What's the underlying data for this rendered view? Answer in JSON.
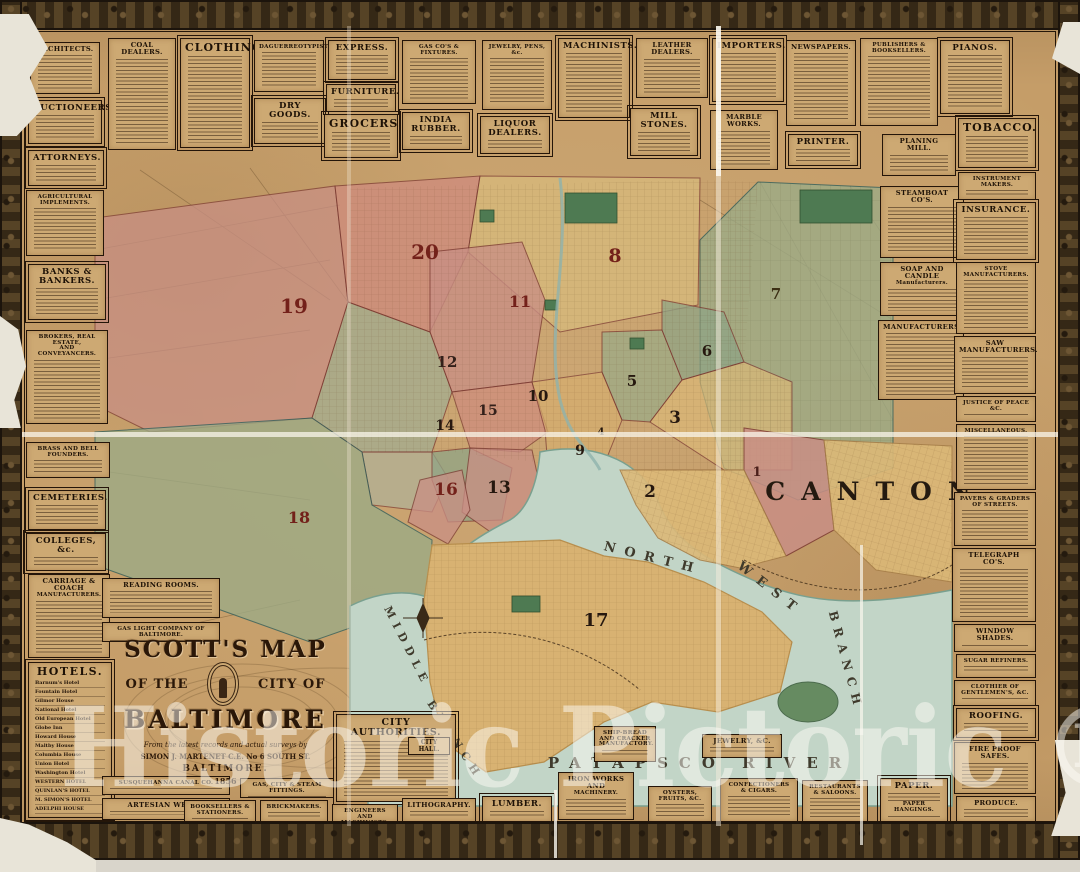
{
  "watermark": "Historic Pictoric ®",
  "cartouche": {
    "arc_title": "SCOTT'S MAP",
    "left": "OF THE",
    "right": "CITY OF",
    "city": "BALTIMORE",
    "sub1": "From the latest records and actual surveys by",
    "sub2": "SIMON J. MARTENET C.E. No 6 SOUTH ST.",
    "sub3": "BALTIMORE.",
    "date": "1856"
  },
  "colors": {
    "paper": "#c59d68",
    "frame": "#42331f",
    "water": "#c2d5c7",
    "ward_pink": "#c98f85",
    "ward_tan": "#d6ae6e",
    "ward_green": "#9cab86",
    "ward_number_red": "#73211a",
    "ink": "#241509",
    "watermark_white": "rgba(253,251,245,0.5)"
  },
  "map": {
    "region_label": "CANTON",
    "canton": {
      "x": 876,
      "y": 500,
      "s": 25,
      "ls": 16
    },
    "water_labels": [
      {
        "text": "NORTH",
        "x": 652,
        "y": 562,
        "s": 13,
        "r": 14,
        "ls": 9
      },
      {
        "text": "WEST",
        "x": 768,
        "y": 592,
        "s": 13,
        "r": 38,
        "ls": 9
      },
      {
        "text": "BRANCH",
        "x": 842,
        "y": 662,
        "s": 12,
        "r": 75,
        "ls": 7
      },
      {
        "text": "MIDDLE",
        "x": 404,
        "y": 648,
        "s": 11,
        "r": 63,
        "ls": 6
      },
      {
        "text": "BRANCH",
        "x": 452,
        "y": 742,
        "s": 11,
        "r": 57,
        "ls": 6
      },
      {
        "text": "PATAPSCO RIVER",
        "x": 700,
        "y": 768,
        "s": 15,
        "r": 0,
        "ls": 11
      }
    ],
    "wards": [
      {
        "n": "1",
        "x": 757,
        "y": 476,
        "s": 13,
        "c": "#4a1f1a"
      },
      {
        "n": "2",
        "x": 650,
        "y": 497,
        "s": 17,
        "c": "#26180f"
      },
      {
        "n": "3",
        "x": 675,
        "y": 423,
        "s": 17,
        "c": "#26180f"
      },
      {
        "n": "4",
        "x": 601,
        "y": 435,
        "s": 10,
        "c": "#26180f"
      },
      {
        "n": "5",
        "x": 632,
        "y": 386,
        "s": 15,
        "c": "#26180f"
      },
      {
        "n": "6",
        "x": 707,
        "y": 356,
        "s": 15,
        "c": "#26180f"
      },
      {
        "n": "7",
        "x": 776,
        "y": 299,
        "s": 15,
        "c": "#3c2f14"
      },
      {
        "n": "8",
        "x": 615,
        "y": 262,
        "s": 19,
        "c": "#73211a"
      },
      {
        "n": "9",
        "x": 580,
        "y": 455,
        "s": 14,
        "c": "#26180f"
      },
      {
        "n": "10",
        "x": 538,
        "y": 401,
        "s": 15,
        "c": "#26180f"
      },
      {
        "n": "11",
        "x": 520,
        "y": 307,
        "s": 16,
        "c": "#73211a"
      },
      {
        "n": "12",
        "x": 447,
        "y": 367,
        "s": 15,
        "c": "#33201a"
      },
      {
        "n": "13",
        "x": 499,
        "y": 493,
        "s": 17,
        "c": "#26180f"
      },
      {
        "n": "14",
        "x": 445,
        "y": 430,
        "s": 14,
        "c": "#26180f"
      },
      {
        "n": "15",
        "x": 488,
        "y": 415,
        "s": 14,
        "c": "#33201a"
      },
      {
        "n": "16",
        "x": 446,
        "y": 495,
        "s": 17,
        "c": "#73211a"
      },
      {
        "n": "17",
        "x": 596,
        "y": 626,
        "s": 18,
        "c": "#26180f"
      },
      {
        "n": "18",
        "x": 299,
        "y": 523,
        "s": 16,
        "c": "#73211a"
      },
      {
        "n": "19",
        "x": 294,
        "y": 313,
        "s": 20,
        "c": "#73211a"
      },
      {
        "n": "20",
        "x": 425,
        "y": 259,
        "s": 20,
        "c": "#73211a"
      }
    ]
  },
  "panels": [
    {
      "id": "architects",
      "t": "ARCHITECTS.",
      "x": 30,
      "y": 42,
      "w": 70,
      "h": 52,
      "v": "n"
    },
    {
      "id": "auctioneers",
      "t": "AUCTIONEERS.",
      "x": 28,
      "y": 100,
      "w": 74,
      "h": 44,
      "v": "d2"
    },
    {
      "id": "attorneys",
      "t": "ATTORNEYS.",
      "x": 28,
      "y": 150,
      "w": 76,
      "h": 36,
      "v": "d2"
    },
    {
      "id": "coal-dealers",
      "t": "COAL DEALERS.",
      "x": 108,
      "y": 38,
      "w": 68,
      "h": 112,
      "v": "n"
    },
    {
      "id": "clothing",
      "t": "CLOTHING.",
      "x": 180,
      "y": 38,
      "w": 70,
      "h": 110,
      "v": "d"
    },
    {
      "id": "daguerreotypists",
      "t": "DAGUERREOTYPISTS.",
      "x": 254,
      "y": 40,
      "w": 70,
      "h": 52,
      "v": "s"
    },
    {
      "id": "dry-goods",
      "t": "DRY GOODS.",
      "x": 254,
      "y": 98,
      "w": 72,
      "h": 46,
      "v": "d2"
    },
    {
      "id": "express",
      "t": "EXPRESS.",
      "x": 328,
      "y": 40,
      "w": 68,
      "h": 40,
      "v": "d2"
    },
    {
      "id": "furniture",
      "t": "FURNITURE.",
      "x": 326,
      "y": 84,
      "w": 70,
      "h": 28,
      "v": "d2"
    },
    {
      "id": "grocers",
      "t": "GROCERS.",
      "x": 324,
      "y": 114,
      "w": 74,
      "h": 44,
      "v": "d"
    },
    {
      "id": "gas-cos-fixtures",
      "t": "GAS CO'S & FIXTURES.",
      "x": 402,
      "y": 40,
      "w": 74,
      "h": 64,
      "v": "s"
    },
    {
      "id": "india-rubber",
      "t": "INDIA RUBBER.",
      "x": 402,
      "y": 112,
      "w": 68,
      "h": 38,
      "v": "d2"
    },
    {
      "id": "jewelry-pens",
      "t": "JEWELRY, PENS, &c.",
      "x": 482,
      "y": 40,
      "w": 70,
      "h": 70,
      "v": "s"
    },
    {
      "id": "liquor-dealers",
      "t": "LIQUOR DEALERS.",
      "x": 480,
      "y": 116,
      "w": 70,
      "h": 38,
      "v": "d2"
    },
    {
      "id": "machinists",
      "t": "MACHINISTS.",
      "x": 558,
      "y": 38,
      "w": 72,
      "h": 80,
      "v": "d2"
    },
    {
      "id": "mill-stones",
      "t": "MILL STONES.",
      "x": 630,
      "y": 108,
      "w": 68,
      "h": 48,
      "v": "d2"
    },
    {
      "id": "leather-dealers",
      "t": "LEATHER DEALERS.",
      "x": 636,
      "y": 38,
      "w": 72,
      "h": 60,
      "v": "n"
    },
    {
      "id": "importers",
      "t": "IMPORTERS.",
      "x": 712,
      "y": 38,
      "w": 72,
      "h": 64,
      "v": "d2"
    },
    {
      "id": "marble-works",
      "t": "MARBLE WORKS.",
      "x": 710,
      "y": 110,
      "w": 68,
      "h": 60,
      "v": "n"
    },
    {
      "id": "newspapers",
      "t": "NEWSPAPERS.",
      "x": 786,
      "y": 40,
      "w": 70,
      "h": 86,
      "v": "n"
    },
    {
      "id": "printer",
      "t": "PRINTER.",
      "x": 788,
      "y": 134,
      "w": 70,
      "h": 32,
      "v": "d2"
    },
    {
      "id": "publishers-booksellers",
      "t": "PUBLISHERS & BOOKSELLERS.",
      "x": 860,
      "y": 38,
      "w": 78,
      "h": 88,
      "v": "s"
    },
    {
      "id": "planing-mill",
      "t": "PLANING MILL.",
      "x": 882,
      "y": 134,
      "w": 74,
      "h": 42,
      "v": "n"
    },
    {
      "id": "pianos",
      "t": "PIANOS.",
      "x": 940,
      "y": 40,
      "w": 70,
      "h": 74,
      "v": "d2"
    },
    {
      "id": "tobacco",
      "t": "TOBACCO.",
      "x": 958,
      "y": 118,
      "w": 78,
      "h": 50,
      "v": "d"
    },
    {
      "id": "agricultural-implements",
      "t": "AGRICULTURAL IMPLEMENTS.",
      "x": 26,
      "y": 190,
      "w": 78,
      "h": 66,
      "v": "s"
    },
    {
      "id": "banks-bankers",
      "t": "BANKS & BANKERS.",
      "x": 28,
      "y": 264,
      "w": 78,
      "h": 56,
      "v": "d2"
    },
    {
      "id": "brokers",
      "t": "BROKERS, REAL ESTATE,|AND CONVEYANCERS.",
      "x": 26,
      "y": 330,
      "w": 82,
      "h": 94,
      "v": "s"
    },
    {
      "id": "brass-bell-founders",
      "t": "BRASS AND BELL FOUNDERS.",
      "x": 26,
      "y": 442,
      "w": 84,
      "h": 36,
      "v": "s"
    },
    {
      "id": "cemeteries",
      "t": "CEMETERIES.",
      "x": 28,
      "y": 490,
      "w": 78,
      "h": 40,
      "v": "d2"
    },
    {
      "id": "colleges",
      "t": "COLLEGES, &c.",
      "x": 26,
      "y": 533,
      "w": 80,
      "h": 38,
      "v": "d2"
    },
    {
      "id": "carriage-coach",
      "t": "CARRIAGE & COACH|MANUFACTURERS.",
      "x": 28,
      "y": 574,
      "w": 82,
      "h": 84,
      "v": "n"
    },
    {
      "id": "hotels",
      "t": "HOTELS.",
      "x": 28,
      "y": 662,
      "w": 84,
      "h": 156,
      "v": "hotels",
      "list": [
        "Barnum's Hotel",
        "Fountain Hotel",
        "Gilmor House",
        "National Hotel",
        "Old European Hotel",
        "Globe Inn",
        "Howard House",
        "Maltby House",
        "Columbia House",
        "Union Hotel",
        "Washington Hotel",
        "WESTERN HOTEL",
        "QUINLAN'S HOTEL",
        "M. SIMON'S HOTEL",
        "ADELPHI HOUSE"
      ]
    },
    {
      "id": "reading-rooms",
      "t": "READING ROOMS.",
      "x": 102,
      "y": 578,
      "w": 118,
      "h": 40,
      "v": "n"
    },
    {
      "id": "gas-light-co",
      "t": "GAS LIGHT COMPANY OF BALTIMORE.",
      "x": 102,
      "y": 622,
      "w": 118,
      "h": 20,
      "v": "s"
    },
    {
      "id": "steamboat-cos",
      "t": "STEAMBOAT CO'S.",
      "x": 880,
      "y": 186,
      "w": 84,
      "h": 72,
      "v": "n"
    },
    {
      "id": "soap-candle",
      "t": "SOAP AND CANDLE|Manufacturers.",
      "x": 880,
      "y": 262,
      "w": 84,
      "h": 54,
      "v": "n"
    },
    {
      "id": "manufacturers",
      "t": "MANUFACTURERS.",
      "x": 878,
      "y": 320,
      "w": 86,
      "h": 80,
      "v": "n"
    },
    {
      "id": "instrument-makers",
      "t": "INSTRUMENT MAKERS.",
      "x": 958,
      "y": 172,
      "w": 78,
      "h": 28,
      "v": "s"
    },
    {
      "id": "insurance",
      "t": "INSURANCE.",
      "x": 956,
      "y": 202,
      "w": 80,
      "h": 58,
      "v": "d2"
    },
    {
      "id": "stove-manufacturers",
      "t": "STOVE MANUFACTURERS.",
      "x": 956,
      "y": 262,
      "w": 80,
      "h": 72,
      "v": "s"
    },
    {
      "id": "saw-manufacturers",
      "t": "SAW MANUFACTURERS.",
      "x": 954,
      "y": 336,
      "w": 82,
      "h": 58,
      "v": "n"
    },
    {
      "id": "justice-of-peace",
      "t": "JUSTICE OF PEACE &C.",
      "x": 956,
      "y": 396,
      "w": 80,
      "h": 26,
      "v": "s"
    },
    {
      "id": "miscellaneous",
      "t": "MISCELLANEOUS.",
      "x": 956,
      "y": 424,
      "w": 80,
      "h": 66,
      "v": "s"
    },
    {
      "id": "pavers-graders",
      "t": "PAVERS & GRADERS OF STREETS.",
      "x": 954,
      "y": 492,
      "w": 82,
      "h": 54,
      "v": "s"
    },
    {
      "id": "telegraph-cos",
      "t": "TELEGRAPH CO'S.",
      "x": 952,
      "y": 548,
      "w": 84,
      "h": 74,
      "v": "n"
    },
    {
      "id": "window-shades",
      "t": "WINDOW SHADES.",
      "x": 954,
      "y": 624,
      "w": 82,
      "h": 28,
      "v": "n"
    },
    {
      "id": "sugar-refiners",
      "t": "SUGAR REFINERS.",
      "x": 956,
      "y": 654,
      "w": 80,
      "h": 24,
      "v": "s"
    },
    {
      "id": "clothier-gentlemens",
      "t": "CLOTHIER OF GENTLEMEN'S, &C.",
      "x": 954,
      "y": 680,
      "w": 82,
      "h": 26,
      "v": "s"
    },
    {
      "id": "roofing",
      "t": "ROOFING.",
      "x": 956,
      "y": 708,
      "w": 80,
      "h": 30,
      "v": "d2"
    },
    {
      "id": "fire-proof-safes",
      "t": "FIRE PROOF SAFES.",
      "x": 954,
      "y": 742,
      "w": 82,
      "h": 52,
      "v": "n"
    },
    {
      "id": "produce",
      "t": "PRODUCE.",
      "x": 956,
      "y": 796,
      "w": 80,
      "h": 26,
      "v": "n"
    },
    {
      "id": "city-authorities",
      "t": "CITY AUTHORITIES.",
      "x": 336,
      "y": 714,
      "w": 120,
      "h": 88,
      "v": "city",
      "sub": "CITY HALL."
    },
    {
      "id": "susquehanna-canal",
      "t": "SUSQUEHANNA CANAL CO.",
      "x": 102,
      "y": 776,
      "w": 128,
      "h": 19,
      "v": "s"
    },
    {
      "id": "artesian-wells",
      "t": "ARTESIAN WELLS.",
      "x": 102,
      "y": 798,
      "w": 128,
      "h": 22,
      "v": "n"
    },
    {
      "id": "gas-city-steam",
      "t": "GAS, CITY & STEAM FITTINGS.",
      "x": 240,
      "y": 778,
      "w": 94,
      "h": 20,
      "v": "s"
    },
    {
      "id": "booksellers-stationers",
      "t": "BOOKSELLERS & STATIONERS.",
      "x": 184,
      "y": 800,
      "w": 72,
      "h": 22,
      "v": "s"
    },
    {
      "id": "brickmakers",
      "t": "BRICKMAKERS.",
      "x": 260,
      "y": 800,
      "w": 68,
      "h": 22,
      "v": "s"
    },
    {
      "id": "engineers-machinists",
      "t": "ENGINEERS AND MACHINISTS.",
      "x": 332,
      "y": 804,
      "w": 66,
      "h": 18,
      "v": "s"
    },
    {
      "id": "lithography",
      "t": "LITHOGRAPHY.",
      "x": 402,
      "y": 798,
      "w": 74,
      "h": 24,
      "v": "n"
    },
    {
      "id": "lumber",
      "t": "LUMBER.",
      "x": 482,
      "y": 796,
      "w": 70,
      "h": 26,
      "v": "d2"
    },
    {
      "id": "iron-works",
      "t": "IRON WORKS AND|MACHINERY.",
      "x": 558,
      "y": 772,
      "w": 76,
      "h": 48,
      "v": "n"
    },
    {
      "id": "ship-bread",
      "t": "SHIP-BREAD AND CRACKER|MANUFACTORY.",
      "x": 594,
      "y": 726,
      "w": 62,
      "h": 36,
      "v": "s"
    },
    {
      "id": "jewelry-c",
      "t": "JEWELRY, &C.",
      "x": 702,
      "y": 734,
      "w": 80,
      "h": 24,
      "v": "n"
    },
    {
      "id": "oysters-fruits",
      "t": "OYSTERS, FRUITS, &C.",
      "x": 648,
      "y": 786,
      "w": 64,
      "h": 36,
      "v": "s"
    },
    {
      "id": "confectioners-cigars",
      "t": "CONFECTIONERS & CIGARS.",
      "x": 720,
      "y": 778,
      "w": 78,
      "h": 44,
      "v": "s"
    },
    {
      "id": "restaurants-saloons",
      "t": "RESTAURANTS & SALOONS.",
      "x": 802,
      "y": 780,
      "w": 66,
      "h": 42,
      "v": "s"
    },
    {
      "id": "paper",
      "t": "PAPER.|PAPER HANGINGS.",
      "x": 880,
      "y": 778,
      "w": 68,
      "h": 44,
      "v": "d2",
      "gap": true
    }
  ]
}
